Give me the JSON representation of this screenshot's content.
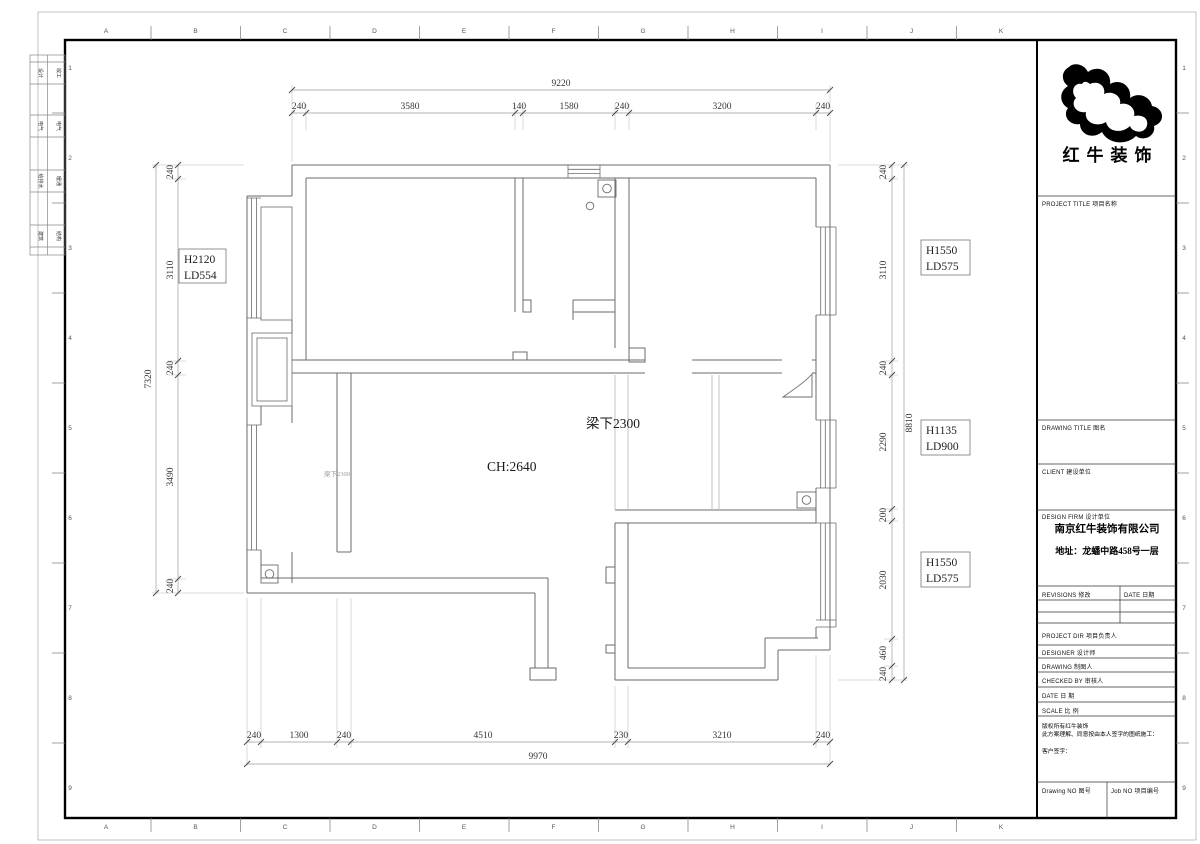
{
  "title_block": {
    "logo_text": "红牛装饰",
    "project_title": "PROJECT TITLE   项目名称",
    "drawing_title": "DRAWING TITLE   图名",
    "client": "CLIENT  建设单位",
    "design_firm": "DESIGN FIRM  设计单位",
    "firm_name": "南京红牛装饰有限公司",
    "firm_address": "地址：龙蟠中路458号一层",
    "revisions": "REVISIONS 修改",
    "date_col": "DATE 日期",
    "project_dir": "PROJECT DIR   项目负责人",
    "designer": "DESIGNER      设计师",
    "drawing": "DRAWING      制图人",
    "checked_by": "CHECKED BY  审核人",
    "date_row": "DATE            日  期",
    "scale_row": "SCALE          比  例",
    "copyright_line1": "版权所有红牛装饰",
    "copyright_line2": "此方案理解、同意按由本人签字的图纸施工：",
    "signature": "客户签字：",
    "drawing_no": "Drawing NO  图号",
    "job_no": "Job NO  项目编号"
  },
  "plan_labels": {
    "ceiling_height": "CH:2640",
    "beam": "梁下2300",
    "beam_small": "梁下2300"
  },
  "tags": {
    "left1a": "H2120",
    "left1b": "LD554",
    "right1a": "H1550",
    "right1b": "LD575",
    "right2a": "H1135",
    "right2b": "LD900",
    "right3a": "H1550",
    "right3b": "LD575"
  },
  "dims": {
    "top": {
      "overall": "9220",
      "segs": [
        "240",
        "3580",
        "140",
        "1580",
        "240",
        "3200",
        "240"
      ]
    },
    "bottom": {
      "overall": "9970",
      "segs": [
        "240",
        "1300",
        "240",
        "4510",
        "230",
        "3210",
        "240"
      ]
    },
    "left": {
      "overall": "7320",
      "segs": [
        "240",
        "3110",
        "240",
        "3490",
        "240"
      ]
    },
    "right": {
      "overall": "8810",
      "segs": [
        "240",
        "3110",
        "240",
        "2290",
        "200",
        "2030",
        "460",
        "240"
      ]
    }
  },
  "frame": {
    "cols": [
      "A",
      "B",
      "C",
      "D",
      "E",
      "F",
      "G",
      "H",
      "I",
      "J",
      "K"
    ],
    "rows": [
      "1",
      "2",
      "3",
      "4",
      "5",
      "6",
      "7",
      "8",
      "9"
    ]
  },
  "strip": {
    "rows": [
      [
        "设计",
        "竣工"
      ],
      [
        "电气",
        "电气"
      ],
      [
        "给排水",
        "暖通"
      ],
      [
        "建筑",
        "结构"
      ]
    ]
  }
}
